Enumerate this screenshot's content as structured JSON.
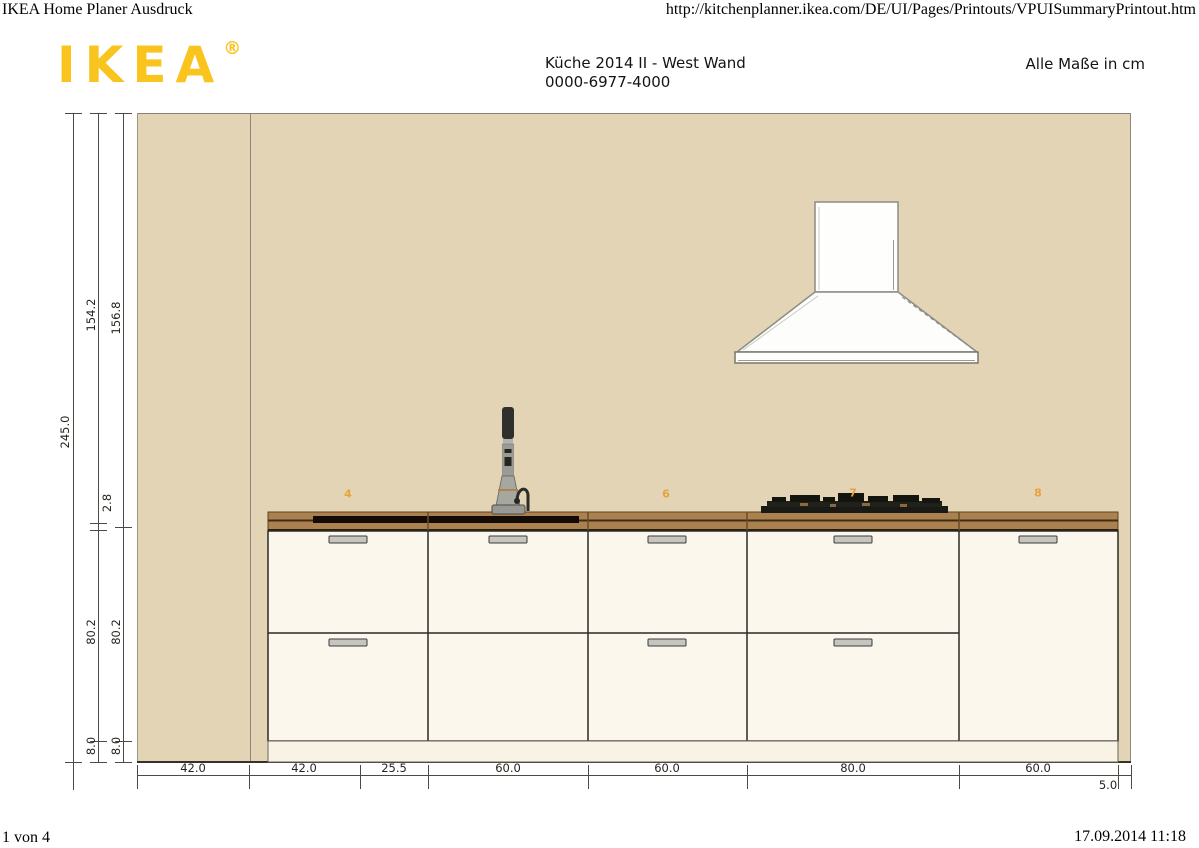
{
  "header": {
    "page_title": "IKEA Home Planer Ausdruck",
    "url": "http://kitchenplanner.ikea.com/DE/UI/Pages/Printouts/VPUISummaryPrintout.htm",
    "logo_text": "IKEA",
    "logo_registered": "®",
    "plan_title": "Küche 2014 II - West Wand",
    "plan_number": "0000-6977-4000",
    "units_note": "Alle Maße in cm"
  },
  "footer": {
    "page_indicator": "1 von 4",
    "timestamp": "17.09.2014 11:18"
  },
  "drawing": {
    "item_labels": [
      "4",
      "6",
      "7",
      "8"
    ],
    "dims_vertical": [
      "245.0",
      "154.2",
      "156.8",
      "2.8",
      "80.2",
      "80.2",
      "8.0",
      "8.0"
    ],
    "dims_horizontal": [
      "42.0",
      "42.0",
      "25.5",
      "60.0",
      "60.0",
      "80.0",
      "60.0",
      "5.0"
    ],
    "colors": {
      "wall": "#e3d4b6",
      "worktop": "#ab8150",
      "worktop_edge_dark": "#2a1d0e",
      "sink_strip": "#120b06",
      "cabinet_front": "#fbf7ec",
      "plinth": "#f8f3e5",
      "handle": "#c6c6c1",
      "item_label_orange": "#E8A23C",
      "logo_yellow": "#F8C41D",
      "dim_line": "#4e4a43"
    }
  }
}
